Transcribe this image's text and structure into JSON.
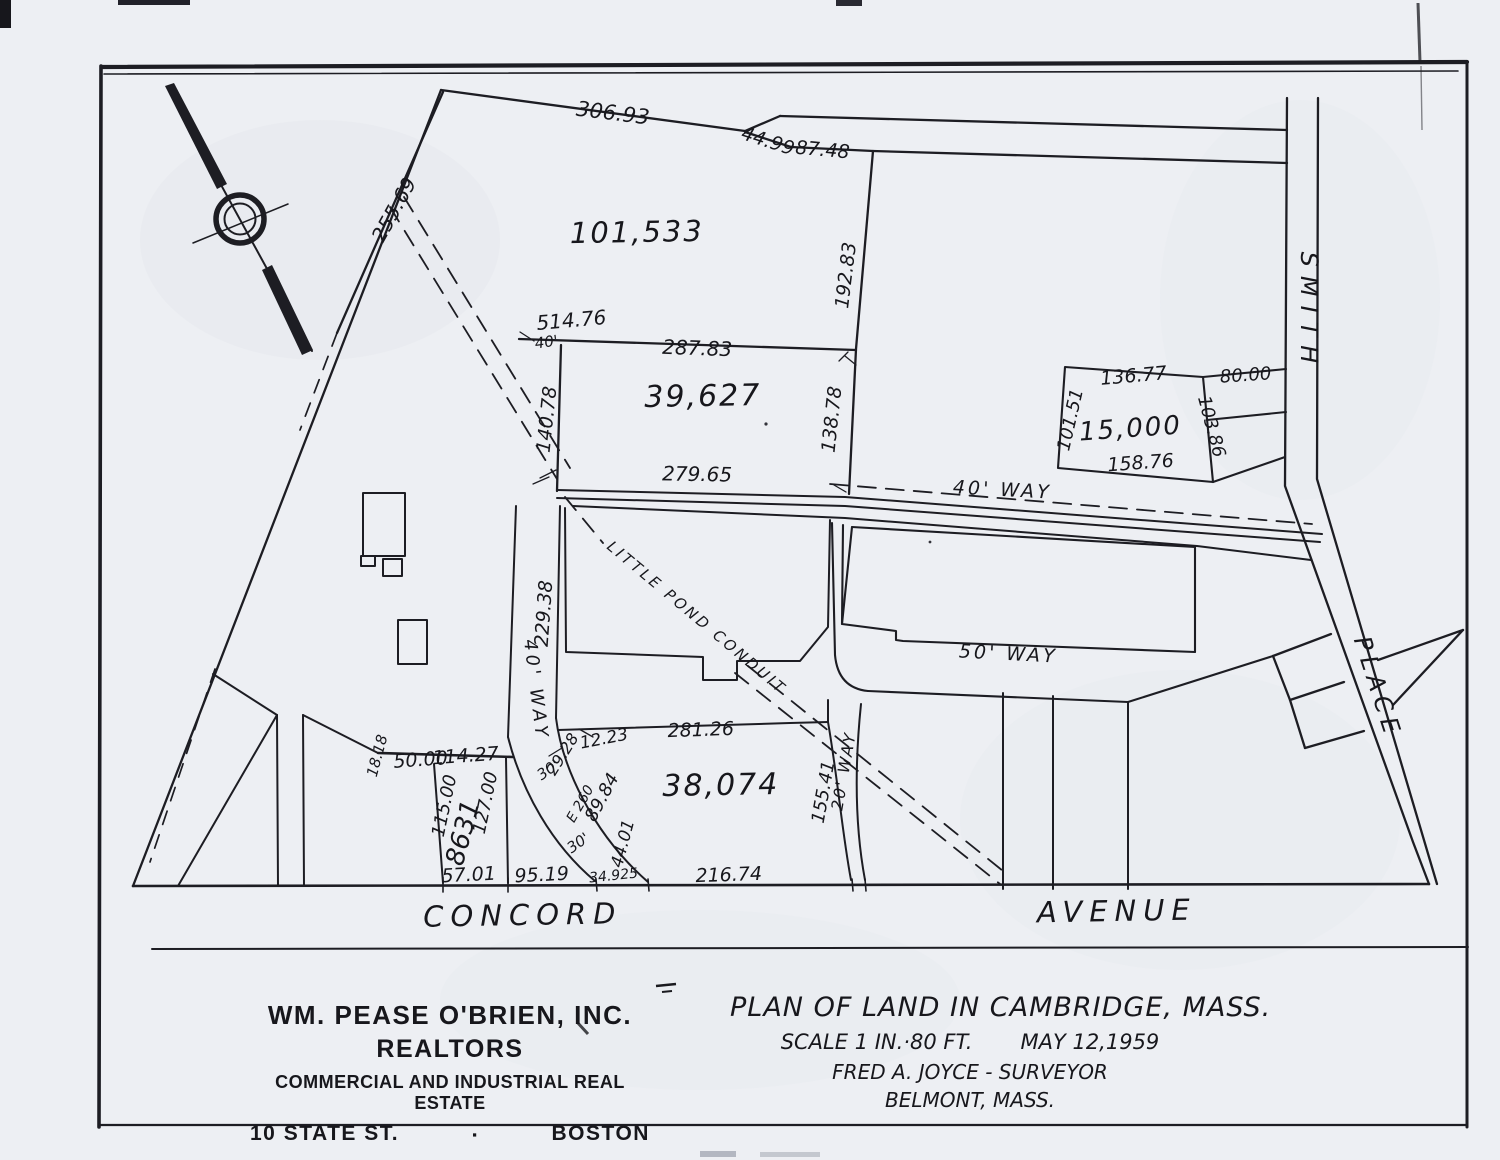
{
  "plan": {
    "areas": {
      "a101533": "101,533",
      "a39627": "39,627",
      "a15000": "15,000",
      "a38074": "38,074",
      "a8631": "8631"
    },
    "streets": {
      "concord": "CONCORD",
      "avenue": "AVENUE",
      "smith": "SMITH",
      "place": "PLACE"
    },
    "ways": {
      "forty_h": "40' WAY",
      "forty_v": "40' WAY",
      "fifty": "50' WAY",
      "twenty": "20' WAY",
      "forty_width": "40'"
    },
    "conduit_label": "LITTLE POND CONDUIT",
    "dims": {
      "d306_93": "306.93",
      "d44_99": "44.99",
      "d87_48": "87.48",
      "d255_69": "255.69",
      "d192_83": "192.83",
      "d514_76": "514.76",
      "d287_83": "287.83",
      "d140_78": "140.78",
      "d138_78": "138.78",
      "d136_77": "136.77",
      "d80_00": "80.00",
      "d101_51": "101.51",
      "d103_86": "103.86",
      "d158_76": "158.76",
      "d279_65": "279.65",
      "d229_38": "229.38",
      "d12_23": "12.23",
      "d29_28": "29.28",
      "d30_a": "30'",
      "d30_b": "30'",
      "dE260": "E 260",
      "d89_84": "89.84",
      "d44_01": "44.01",
      "d34_925": "34.925",
      "d281_26": "281.26",
      "d155_41": "155.41",
      "d18_18": "18.18",
      "d50_00": "50.00",
      "d114_27": "114.27",
      "d115_00": "115.00",
      "d127_00": "127.00",
      "d57_01": "57.01",
      "d95_19": "95.19",
      "d216_74": "216.74"
    }
  },
  "firm_block": {
    "line1": "WM. PEASE O'BRIEN, INC.",
    "line2": "REALTORS",
    "line3": "COMMERCIAL AND INDUSTRIAL REAL ESTATE",
    "line4_left": "10 STATE ST.",
    "line4_sep": "▪",
    "line4_right": "BOSTON"
  },
  "title_block": {
    "line1": "PLAN OF LAND IN CAMBRIDGE, MASS.",
    "line2_scale": "SCALE 1 IN.·80 FT.",
    "line2_date": "MAY 12,1959",
    "line3": "FRED A. JOYCE - SURVEYOR",
    "line4": "BELMONT, MASS."
  }
}
